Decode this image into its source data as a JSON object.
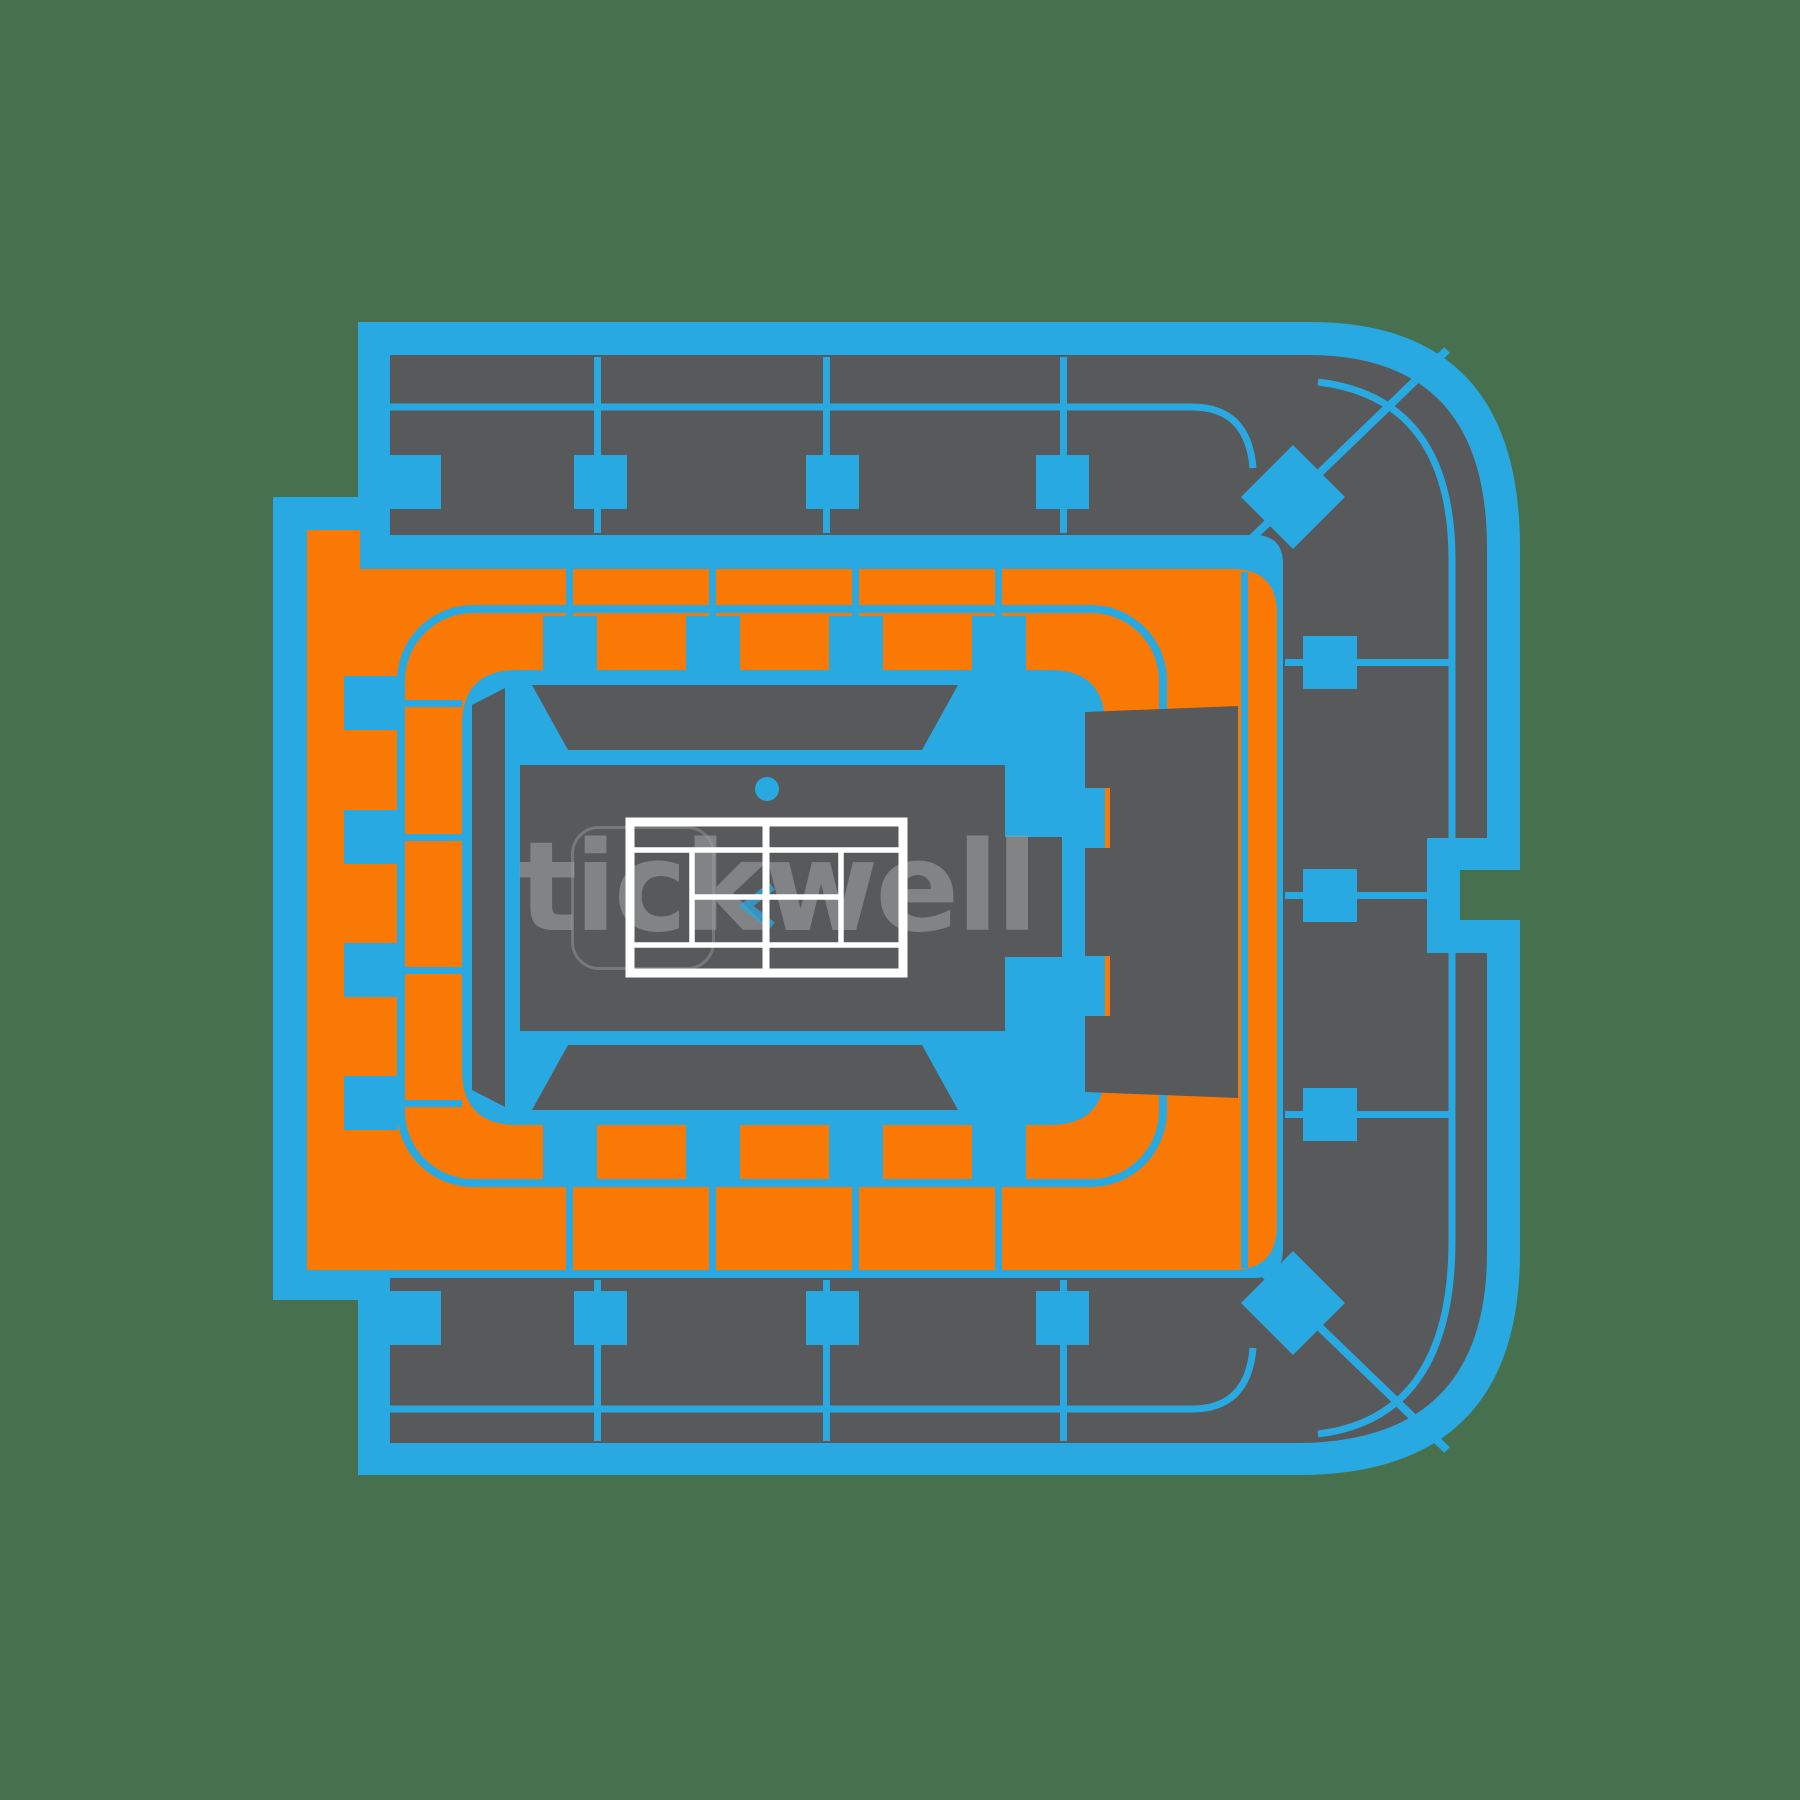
{
  "watermark": {
    "text": "tickwell"
  },
  "colors": {
    "background": "#47714E",
    "blue": "#29A9E1",
    "orange": "#FA7905",
    "gray": "#58595B",
    "court_line": "#FFFFFF",
    "watermark_text": "#9B9DA0"
  },
  "map": {
    "type": "venue-seating-map",
    "venue_feature": "tennis-court",
    "zones": {
      "upper_deck": "gray",
      "lower_bowl": "orange",
      "concourse": "blue",
      "courtside": "gray"
    }
  }
}
